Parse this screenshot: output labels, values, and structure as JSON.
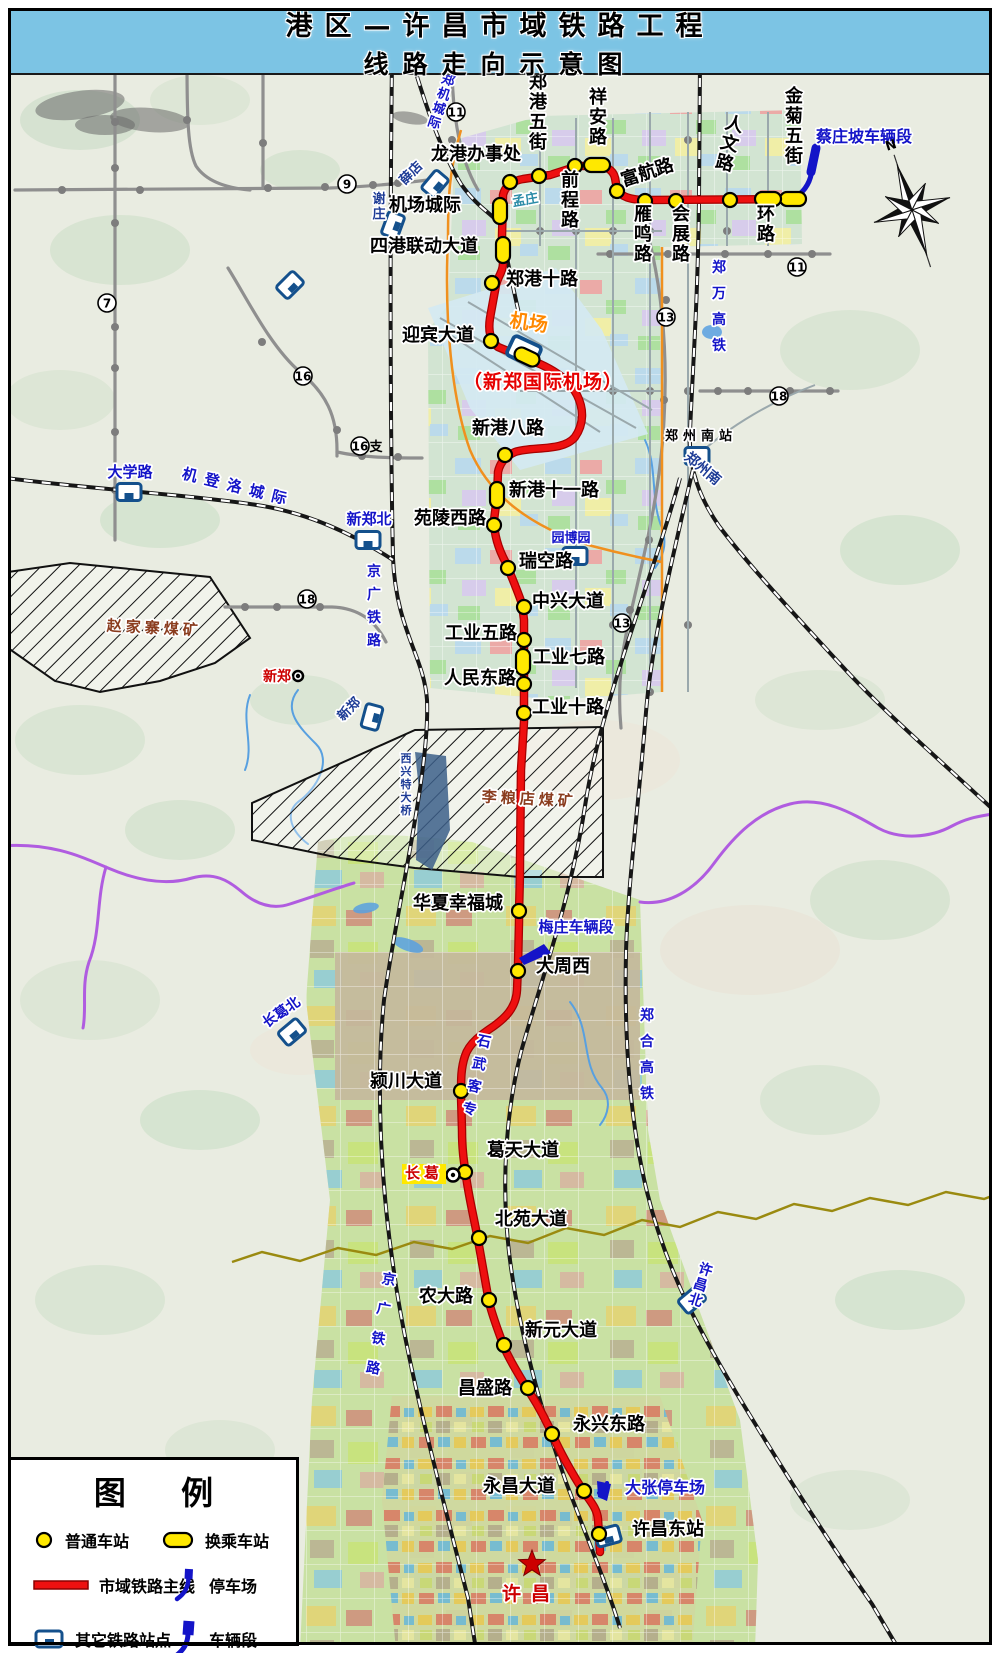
{
  "title": {
    "line1": "港区—许昌市域铁路工程",
    "line2": "线路走向示意图"
  },
  "compass_label": "N",
  "legend": {
    "title": "图 例",
    "items": {
      "normal_station": "普通车站",
      "transfer_station": "换乘车站",
      "mainline": "市域铁路主线",
      "parking": "停车场",
      "other_station": "其它铁路站点",
      "depot": "车辆段"
    }
  },
  "colors": {
    "route": "#ee1010",
    "route_edge": "#a80000",
    "station_fill": "#ffe800",
    "depot_blue": "#1414c8",
    "metro_gray": "#8f8f8f",
    "rail_black": "#161616",
    "orange_road": "#f0901e",
    "purple_river": "#b05ce0",
    "olive_river": "#9a8a10",
    "stream_blue": "#58a0e0",
    "title_band": "#7cc4e4"
  },
  "route": {
    "name": "市域铁路主线",
    "path": "M793,199 L648,200 C630,200 621,197 617,189 L615,178 C613,169 605,166 596,166 L578,166 L550,175 L523,179 C512,181 505,186 503,195 L502,236 L503,263 C503,272 498,276 496,285 L490,318 C488,331 490,340 498,347 L540,364 C560,373 571,383 577,395 C584,409 584,424 575,437 C563,452 532,446 515,452 C506,456 500,462 498,472 L497,497 L494,520 C494,538 500,552 506,563 C513,580 518,592 522,604 L524,620 L524,722 L521,770 L520,860 C520,890 519,898 519,922 L518,966 L517,990 C516,1008 505,1018 494,1026 C482,1034 469,1043 465,1056 C461,1068 461,1078 461,1096 L462,1130 C462,1150 464,1162 466,1176 C469,1198 474,1218 478,1240 C482,1262 485,1280 489,1302 C493,1318 498,1330 504,1347 C511,1363 519,1375 528,1390 C538,1405 545,1418 553,1436 C562,1456 572,1473 582,1489 C590,1501 597,1508 598,1519 L600,1552"
  },
  "stations": [
    {
      "n": "金菊五街",
      "x": 793,
      "y": 199,
      "t": "th",
      "lx": 794,
      "ly": 102,
      "o": "v"
    },
    {
      "n": "环路",
      "x": 768,
      "y": 199,
      "t": "th",
      "lx": 766,
      "ly": 220,
      "o": "v"
    },
    {
      "n": "人文路",
      "x": 730,
      "y": 200,
      "t": "n",
      "lx": 733,
      "ly": 130,
      "o": "v",
      "r": 14
    },
    {
      "n": "会展路",
      "x": 676,
      "y": 201,
      "t": "n",
      "lx": 681,
      "ly": 220,
      "o": "v"
    },
    {
      "n": "雁鸣路",
      "x": 645,
      "y": 201,
      "t": "n",
      "lx": 643,
      "ly": 220,
      "o": "v"
    },
    {
      "n": "富航路",
      "x": 617,
      "y": 191,
      "t": "n",
      "lx": 649,
      "ly": 178,
      "o": "h",
      "r": -18
    },
    {
      "n": "祥安路",
      "x": 597,
      "y": 165,
      "t": "th",
      "lx": 598,
      "ly": 103,
      "o": "v"
    },
    {
      "n": "前程路",
      "x": 575,
      "y": 166,
      "t": "n",
      "lx": 570,
      "ly": 186,
      "o": "v"
    },
    {
      "n": "郑港五街",
      "x": 539,
      "y": 176,
      "t": "n",
      "lx": 538,
      "ly": 88,
      "o": "v"
    },
    {
      "n": "龙港办事处",
      "x": 510,
      "y": 182,
      "t": "n",
      "lx": 476,
      "ly": 160,
      "o": "h"
    },
    {
      "n": "机场城际",
      "x": 500,
      "y": 211,
      "t": "tv",
      "lx": 425,
      "ly": 211,
      "o": "h"
    },
    {
      "n": "四港联动大道",
      "x": 503,
      "y": 250,
      "t": "tv",
      "lx": 424,
      "ly": 252,
      "o": "h"
    },
    {
      "n": "郑港十路",
      "x": 492,
      "y": 283,
      "t": "n",
      "lx": 542,
      "ly": 285,
      "o": "h"
    },
    {
      "n": "迎宾大道",
      "x": 491,
      "y": 341,
      "t": "n",
      "lx": 438,
      "ly": 341,
      "o": "h"
    },
    {
      "n": "机场",
      "x": 527,
      "y": 357,
      "t": "td"
    },
    {
      "n": "新港八路",
      "x": 505,
      "y": 455,
      "t": "n",
      "lx": 508,
      "ly": 434,
      "o": "h"
    },
    {
      "n": "新港十一路",
      "x": 497,
      "y": 495,
      "t": "tv",
      "lx": 554,
      "ly": 496,
      "o": "h"
    },
    {
      "n": "苑陵西路",
      "x": 494,
      "y": 525,
      "t": "n",
      "lx": 450,
      "ly": 524,
      "o": "h"
    },
    {
      "n": "瑞空路",
      "x": 508,
      "y": 568,
      "t": "n",
      "lx": 546,
      "ly": 567,
      "o": "h"
    },
    {
      "n": "中兴大道",
      "x": 524,
      "y": 607,
      "t": "n",
      "lx": 568,
      "ly": 607,
      "o": "h"
    },
    {
      "n": "工业五路",
      "x": 524,
      "y": 640,
      "t": "n",
      "lx": 481,
      "ly": 639,
      "o": "h"
    },
    {
      "n": "工业七路",
      "x": 523,
      "y": 662,
      "t": "tv",
      "lx": 569,
      "ly": 663,
      "o": "h"
    },
    {
      "n": "人民东路",
      "x": 524,
      "y": 684,
      "t": "n",
      "lx": 480,
      "ly": 684,
      "o": "h"
    },
    {
      "n": "工业十路",
      "x": 524,
      "y": 713,
      "t": "n",
      "lx": 568,
      "ly": 713,
      "o": "h"
    },
    {
      "n": "华夏幸福城",
      "x": 519,
      "y": 911,
      "t": "n",
      "lx": 458,
      "ly": 909,
      "o": "h"
    },
    {
      "n": "大周西",
      "x": 518,
      "y": 971,
      "t": "n",
      "lx": 563,
      "ly": 972,
      "o": "h"
    },
    {
      "n": "颍川大道",
      "x": 461,
      "y": 1091,
      "t": "n",
      "lx": 406,
      "ly": 1087,
      "o": "h"
    },
    {
      "n": "葛天大道",
      "x": 465,
      "y": 1172,
      "t": "n",
      "lx": 523,
      "ly": 1156,
      "o": "h"
    },
    {
      "n": "北苑大道",
      "x": 479,
      "y": 1238,
      "t": "n",
      "lx": 531,
      "ly": 1225,
      "o": "h"
    },
    {
      "n": "农大路",
      "x": 489,
      "y": 1300,
      "t": "n",
      "lx": 446,
      "ly": 1302,
      "o": "h"
    },
    {
      "n": "新元大道",
      "x": 504,
      "y": 1345,
      "t": "n",
      "lx": 561,
      "ly": 1336,
      "o": "h"
    },
    {
      "n": "昌盛路",
      "x": 528,
      "y": 1388,
      "t": "n",
      "lx": 485,
      "ly": 1394,
      "o": "h"
    },
    {
      "n": "永兴东路",
      "x": 552,
      "y": 1434,
      "t": "n",
      "lx": 609,
      "ly": 1430,
      "o": "h"
    },
    {
      "n": "永昌大道",
      "x": 584,
      "y": 1491,
      "t": "n",
      "lx": 519,
      "ly": 1492,
      "o": "h"
    },
    {
      "n": "许昌东站",
      "x": 599,
      "y": 1534,
      "t": "n",
      "lx": 668,
      "ly": 1535,
      "o": "h"
    }
  ],
  "labels": [
    {
      "t": "蔡庄坡车辆段",
      "x": 864,
      "y": 142,
      "s": 16,
      "c": "#1414c8"
    },
    {
      "t": "郑机城际",
      "x": 447,
      "y": 84,
      "s": 13,
      "c": "#1414c8",
      "o": "v",
      "r": 18
    },
    {
      "t": "薛店",
      "x": 414,
      "y": 176,
      "s": 13,
      "c": "#1e3c96",
      "r": -45
    },
    {
      "t": "谢庄",
      "x": 379,
      "y": 203,
      "s": 13,
      "c": "#1e3c96",
      "o": "v"
    },
    {
      "t": "孟庄",
      "x": 526,
      "y": 204,
      "s": 13,
      "c": "#2b8ca8",
      "r": -10
    },
    {
      "t": "机登洛城际",
      "x": 237,
      "y": 492,
      "s": 15,
      "c": "#1414c8",
      "r": 14,
      "ls": 8
    },
    {
      "t": "大学路",
      "x": 130,
      "y": 477,
      "s": 15,
      "c": "#1414c8"
    },
    {
      "t": "新郑北",
      "x": 369,
      "y": 524,
      "s": 15,
      "c": "#1414c8"
    },
    {
      "t": "京广铁路",
      "x": 374,
      "y": 576,
      "s": 14,
      "c": "#1414c8",
      "o": "v",
      "ls": 9
    },
    {
      "t": "京广铁路",
      "x": 388,
      "y": 1284,
      "s": 14,
      "c": "#1414c8",
      "o": "v",
      "ls": 16,
      "r": 10
    },
    {
      "t": "郑万高铁",
      "x": 719,
      "y": 272,
      "s": 14,
      "c": "#1414c8",
      "o": "v",
      "ls": 12
    },
    {
      "t": "郑合高铁",
      "x": 647,
      "y": 1020,
      "s": 14,
      "c": "#1414c8",
      "o": "v",
      "ls": 12
    },
    {
      "t": "石武客专",
      "x": 483,
      "y": 1046,
      "s": 14,
      "c": "#1414c8",
      "o": "v",
      "ls": 9,
      "r": 12
    },
    {
      "t": "郑州南站",
      "x": 701,
      "y": 440,
      "s": 13,
      "c": "#000000",
      "ls": 5
    },
    {
      "t": "郑州南",
      "x": 700,
      "y": 472,
      "s": 14,
      "c": "#1e3c96",
      "r": 40
    },
    {
      "t": "园博园",
      "x": 571,
      "y": 542,
      "s": 13,
      "c": "#1414c8"
    },
    {
      "t": "新郑",
      "x": 277,
      "y": 681,
      "s": 14,
      "c": "#cc0000"
    },
    {
      "t": "新郑",
      "x": 352,
      "y": 712,
      "s": 13,
      "c": "#1e3c96",
      "r": -45
    },
    {
      "t": "赵家寨煤矿",
      "x": 154,
      "y": 633,
      "s": 15,
      "c": "#8a3c1e",
      "ls": 4,
      "r": 3
    },
    {
      "t": "李粮店煤矿",
      "x": 529,
      "y": 804,
      "s": 15,
      "c": "#8a3c1e",
      "ls": 4,
      "r": 3
    },
    {
      "t": "西兴特大桥",
      "x": 406,
      "y": 762,
      "s": 11,
      "c": "#1e3c96",
      "o": "v"
    },
    {
      "t": "梅庄车辆段",
      "x": 576,
      "y": 932,
      "s": 15,
      "c": "#1414c8"
    },
    {
      "t": "长葛",
      "x": 424,
      "y": 1178,
      "s": 15,
      "c": "#cc0000",
      "bg": "#ffe800",
      "ls": 4
    },
    {
      "t": "长葛北",
      "x": 284,
      "y": 1016,
      "s": 14,
      "c": "#1414c8",
      "r": -35
    },
    {
      "t": "许昌北",
      "x": 704,
      "y": 1274,
      "s": 14,
      "c": "#1414c8",
      "o": "v",
      "r": 18
    },
    {
      "t": "大张停车场",
      "x": 665,
      "y": 1493,
      "s": 16,
      "c": "#1414c8"
    },
    {
      "t": "许昌",
      "x": 531,
      "y": 1600,
      "s": 19,
      "c": "#cc0000",
      "ls": 10
    },
    {
      "t": "机场",
      "x": 528,
      "y": 329,
      "s": 19,
      "c": "#ff8800",
      "r": 8
    },
    {
      "t": "（新郑国际机场）",
      "x": 543,
      "y": 388,
      "s": 19,
      "c": "#e60000",
      "ls": 1
    }
  ],
  "line_numbers": [
    {
      "n": "9",
      "x": 347,
      "y": 184
    },
    {
      "n": "11",
      "x": 456,
      "y": 112
    },
    {
      "n": "11",
      "x": 797,
      "y": 267
    },
    {
      "n": "7",
      "x": 107,
      "y": 303
    },
    {
      "n": "16",
      "x": 303,
      "y": 376
    },
    {
      "n": "16",
      "x": 360,
      "y": 446,
      "suffix": "支"
    },
    {
      "n": "18",
      "x": 307,
      "y": 599
    },
    {
      "n": "18",
      "x": 779,
      "y": 396
    },
    {
      "n": "13",
      "x": 666,
      "y": 317
    },
    {
      "n": "13",
      "x": 622,
      "y": 623
    }
  ],
  "rail_icons": [
    {
      "x": 129,
      "y": 492,
      "r": 0
    },
    {
      "x": 368,
      "y": 540,
      "r": 0
    },
    {
      "x": 435,
      "y": 184,
      "r": -50
    },
    {
      "x": 393,
      "y": 225,
      "r": -70
    },
    {
      "x": 290,
      "y": 285,
      "r": -45
    },
    {
      "x": 697,
      "y": 456,
      "r": 0
    },
    {
      "x": 575,
      "y": 556,
      "r": 0
    },
    {
      "x": 372,
      "y": 717,
      "r": -75
    },
    {
      "x": 292,
      "y": 1032,
      "r": -40
    },
    {
      "x": 692,
      "y": 1300,
      "r": -40
    },
    {
      "x": 608,
      "y": 1536,
      "r": -15
    },
    {
      "x": 524,
      "y": 351,
      "r": 25,
      "s": 1.25
    }
  ],
  "railways": [
    {
      "name": "京广铁路",
      "style": "dashed",
      "path": "M392,60 C390,220 390,420 393,558 C396,630 424,656 427,700 C430,770 398,900 384,1000 C376,1080 380,1180 394,1272 C406,1360 438,1480 468,1598 L476,1650"
    },
    {
      "name": "郑机城际",
      "style": "dashed",
      "path": "M412,60 C424,100 440,150 461,184 C477,207 492,214 500,224 C506,252 514,295 523,330"
    },
    {
      "name": "机登洛城际",
      "style": "dashed",
      "path": "M6,478 C80,488 180,494 250,504 C310,512 356,536 393,560"
    },
    {
      "name": "郑万高铁",
      "style": "dashed",
      "path": "M700,60 L699,200 C698,300 692,380 690,432 C688,470 701,500 719,526 C746,562 792,612 842,666 C882,710 942,762 1000,816"
    },
    {
      "name": "郑合高铁",
      "style": "dashed",
      "path": "M697,452 C672,560 652,640 646,712 C638,812 628,882 626,952 C624,1042 630,1122 647,1192 C666,1270 700,1332 737,1394 C772,1452 822,1532 872,1604 L898,1648"
    },
    {
      "name": "石武客专",
      "style": "dashed",
      "path": "M680,478 C652,580 602,700 586,800 C571,900 541,980 521,1052 C506,1112 501,1182 509,1252 C517,1322 541,1412 566,1482 C586,1536 606,1582 620,1628"
    },
    {
      "name": "机场专线",
      "style": "thin",
      "path": "M697,456 C730,425 775,400 815,385"
    },
    {
      "name": "跑道1",
      "style": "thin",
      "path": "M440,318 L636,428"
    },
    {
      "name": "跑道2",
      "style": "thin",
      "path": "M468,302 L652,410"
    },
    {
      "name": "跑道3",
      "style": "thin",
      "path": "M452,336 L600,432"
    },
    {
      "name": "园区道路1",
      "style": "thin",
      "path": "M505,231 L662,231"
    },
    {
      "name": "园区道路2",
      "style": "thin",
      "path": "M520,391 L662,391"
    },
    {
      "name": "园区道路3",
      "style": "thin",
      "path": "M540,118 L540,246"
    },
    {
      "name": "园区道路4",
      "style": "thin",
      "path": "M576,118 L576,688"
    },
    {
      "name": "园区道路5",
      "style": "thin",
      "path": "M613,118 L613,690"
    },
    {
      "name": "园区道路6",
      "style": "thin",
      "path": "M650,112 L650,692"
    },
    {
      "name": "园区道路7",
      "style": "thin",
      "path": "M688,112 L688,692"
    },
    {
      "name": "园区道路8",
      "style": "thin",
      "path": "M727,112 L727,246"
    },
    {
      "name": "园区道路9",
      "style": "thin",
      "path": "M768,112 L768,246"
    }
  ],
  "metro_lines": [
    "M115,64 L115,540",
    "M15,190 L330,188 C360,187 395,184 428,180",
    "M187,62 C187,120 188,150 196,166 C206,181 226,188 250,190",
    "M263,62 L263,188",
    "M228,268 C248,300 270,346 300,372 C326,393 337,416 337,450 L337,456",
    "M337,452 C360,457 385,458 422,458",
    "M452,62 C452,110 458,156 478,190",
    "M598,254 L830,254",
    "M648,235 C662,290 668,350 664,420 C660,500 640,570 627,630 C620,662 618,696 621,728",
    "M225,607 L332,607 C360,608 376,622 386,642",
    "M700,391 L838,391"
  ],
  "metro_dots": [
    [
      115,
      122
    ],
    [
      115,
      168
    ],
    [
      115,
      223
    ],
    [
      115,
      327
    ],
    [
      115,
      368
    ],
    [
      115,
      432
    ],
    [
      115,
      490
    ],
    [
      62,
      190
    ],
    [
      140,
      190
    ],
    [
      187,
      120
    ],
    [
      263,
      143
    ],
    [
      268,
      188
    ],
    [
      325,
      187
    ],
    [
      373,
      185
    ],
    [
      398,
      183
    ],
    [
      262,
      342
    ],
    [
      337,
      430
    ],
    [
      362,
      456
    ],
    [
      398,
      457
    ],
    [
      452,
      140
    ],
    [
      610,
      254
    ],
    [
      668,
      254
    ],
    [
      725,
      254
    ],
    [
      768,
      254
    ],
    [
      812,
      254
    ],
    [
      666,
      300
    ],
    [
      664,
      400
    ],
    [
      649,
      540
    ],
    [
      630,
      610
    ],
    [
      245,
      607
    ],
    [
      277,
      607
    ],
    [
      320,
      607
    ],
    [
      718,
      391
    ],
    [
      748,
      391
    ],
    [
      790,
      391
    ],
    [
      830,
      391
    ],
    [
      540,
      231
    ],
    [
      576,
      231
    ],
    [
      613,
      231
    ],
    [
      650,
      231
    ],
    [
      576,
      391
    ],
    [
      613,
      391
    ],
    [
      650,
      391
    ],
    [
      688,
      391
    ],
    [
      613,
      625
    ],
    [
      650,
      692
    ],
    [
      688,
      625
    ],
    [
      727,
      231
    ],
    [
      768,
      231
    ],
    [
      688,
      140
    ]
  ],
  "orange_roads": [
    "M662,247 L662,692",
    "M461,130 C449,170 448,200 448,238 C444,320 452,400 470,450 C492,502 540,530 592,546 C630,556 652,560 662,562"
  ],
  "rivers": {
    "purple": [
      "M0,846 C50,842 80,856 108,868 C136,880 165,886 192,878 C214,872 228,880 242,892 C256,904 272,910 290,904 C318,895 340,887 354,883",
      "M640,902 C668,906 695,890 715,862 C735,835 758,812 790,804 C822,796 850,812 878,828 C900,840 930,838 952,826 C972,815 988,816 1000,812",
      "M106,867 C96,900 101,932 89,962 C81,986 87,1008 83,1028"
    ],
    "olive": [
      "M232,1262 L262,1252 L300,1261 L338,1248 L376,1255 L414,1242 L452,1249 L490,1236 L528,1243 L566,1228 L604,1235 L642,1220 L680,1227 L718,1212 L756,1219 L794,1204 L832,1211 L870,1198 L908,1205 L946,1192 L984,1199 L1000,1193"
    ],
    "blue": [
      "M298,690 C282,710 300,728 316,744 C332,760 318,788 298,802 C284,814 292,832 308,844",
      "M645,440 C658,468 650,500 662,528 C668,545 662,558 655,568",
      "M570,1002 C592,1030 580,1062 602,1088 C612,1100 608,1115 600,1125",
      "M250,695 C240,720 255,745 245,770"
    ]
  },
  "ponds": [
    {
      "x": 408,
      "y": 945,
      "rx": 16,
      "ry": 6,
      "r": 20
    },
    {
      "x": 366,
      "y": 908,
      "rx": 13,
      "ry": 5,
      "r": -10
    },
    {
      "x": 712,
      "y": 332,
      "rx": 10,
      "ry": 7,
      "r": 0
    },
    {
      "x": 435,
      "y": 905,
      "rx": 10,
      "ry": 5,
      "r": 15
    }
  ],
  "areas": [
    {
      "name": "航空港区规划区",
      "path": "M455,140 L540,116 L800,110 L802,244 L663,247 L662,692 L556,700 L430,688 L428,330 L448,305 Z",
      "fill": "#cfe3d0",
      "overlays": [
        "mosaicA",
        "grid"
      ]
    },
    {
      "name": "新郑国际机场",
      "path": "M428,308 L556,268 L602,330 L648,434 L520,470 L470,408 Z",
      "fill": "#d4e9f2",
      "overlays": []
    },
    {
      "name": "长葛许昌规划区",
      "path": "M318,842 C360,830 420,836 472,842 L640,900 L648,1130 L660,1200 L700,1312 L740,1420 L758,1560 L755,1650 L300,1650 L312,1400 L330,1200 L306,1000 Z",
      "fill": "#c5df9d",
      "overlays": [
        "mosaicB",
        "grid"
      ]
    },
    {
      "name": "大周片区",
      "path": "M335,952 L640,952 L640,1100 L335,1100 Z",
      "fill": "#c4b89c",
      "overlays": [
        "grid"
      ]
    },
    {
      "name": "许昌市区",
      "path": "M392,1396 L660,1396 L702,1520 L692,1650 L396,1650 L382,1500 Z",
      "fill": "#cfd8a0",
      "overlays": [
        "mosaicC",
        "grid"
      ]
    }
  ],
  "hatched_areas": [
    {
      "name": "赵家寨煤矿",
      "path": "M8,572 L70,563 L210,577 L250,638 L215,663 L160,681 L100,692 L55,681 L8,648 Z"
    },
    {
      "name": "李粮店煤矿",
      "path": "M252,803 L415,730 L603,727 L603,877 L520,877 L415,868 L340,858 L252,840 Z"
    }
  ],
  "blue_band": {
    "name": "特大桥水带",
    "path": "M415,752 L446,756 L450,830 L432,870 L416,860 L419,790 Z"
  },
  "depot_shapes": [
    {
      "name": "蔡庄坡车辆段连接线",
      "path": "M796,197 C806,190 811,181 812,169 L814,150",
      "w": 5
    },
    {
      "name": "蔡庄坡车辆段",
      "path": "M811,172 L816,148",
      "w": 9
    },
    {
      "name": "梅庄车辆段",
      "poly": "519,958 544,944 551,953 524,965"
    },
    {
      "name": "大张停车场连接线",
      "path": "M599,1493 C603,1490 606,1487 607,1483",
      "w": 4
    },
    {
      "name": "大张停车场",
      "poly": "597,1481 611,1484 607,1501 598,1497"
    }
  ],
  "city_star": {
    "x": 532,
    "y": 1564,
    "R": 14
  },
  "ring_stations": [
    {
      "x": 453,
      "y": 1175,
      "rr": 6.5
    },
    {
      "x": 298,
      "y": 676,
      "rr": 5
    }
  ]
}
